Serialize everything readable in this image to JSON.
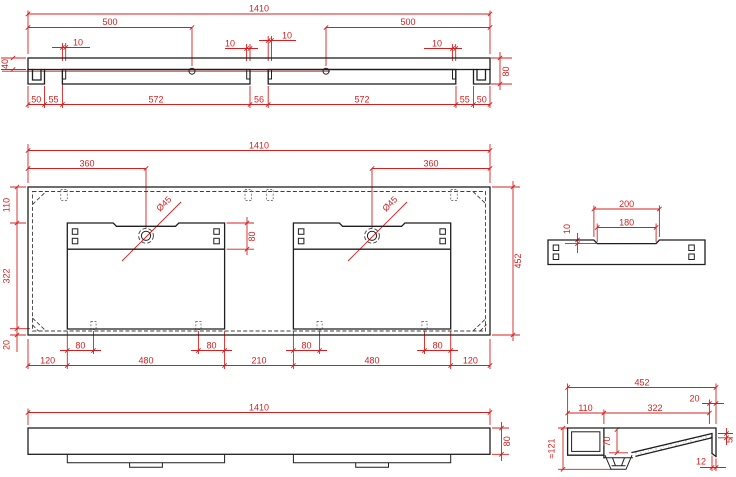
{
  "meta": {
    "type": "technical dimensional drawing",
    "subject": "double wall-hung washbasin",
    "units": "mm"
  },
  "colors": {
    "dimension_red": "#d42020",
    "outline_black": "#1f1f1f",
    "hidden_dash": "#3d3d3d",
    "background": "#ffffff"
  },
  "views": {
    "rail": {
      "name": "top elevation / mounting rail",
      "overall": "1410",
      "hole_left": "500",
      "hole_right": "500",
      "pin1": "10",
      "pin2": "10",
      "pin3": "10",
      "pin4": "10",
      "height_left": "40",
      "height_right": "80",
      "seg": [
        "50",
        "55",
        "572",
        "56",
        "572",
        "55",
        "50"
      ]
    },
    "plan": {
      "name": "plan view",
      "overall": "1410",
      "tap_left": "360",
      "tap_right": "360",
      "tap_dia_left": "Ø45",
      "tap_dia_right": "Ø45",
      "strip": "80",
      "back": "110",
      "depth": "322",
      "front": "20",
      "overall_depth": "452",
      "tabs": [
        "80",
        "80",
        "80",
        "80"
      ],
      "seg": [
        "120",
        "480",
        "210",
        "480",
        "120"
      ]
    },
    "detail": {
      "name": "tap notch detail",
      "outer": "200",
      "inner": "180",
      "depth": "10"
    },
    "front": {
      "name": "front elevation",
      "overall": "1410",
      "height": "80"
    },
    "section": {
      "name": "side section",
      "overall": "452",
      "back": "110",
      "mid": "322",
      "lip": "20",
      "height": "≈121",
      "drop": "70",
      "rim": "5",
      "edge": "12"
    }
  }
}
